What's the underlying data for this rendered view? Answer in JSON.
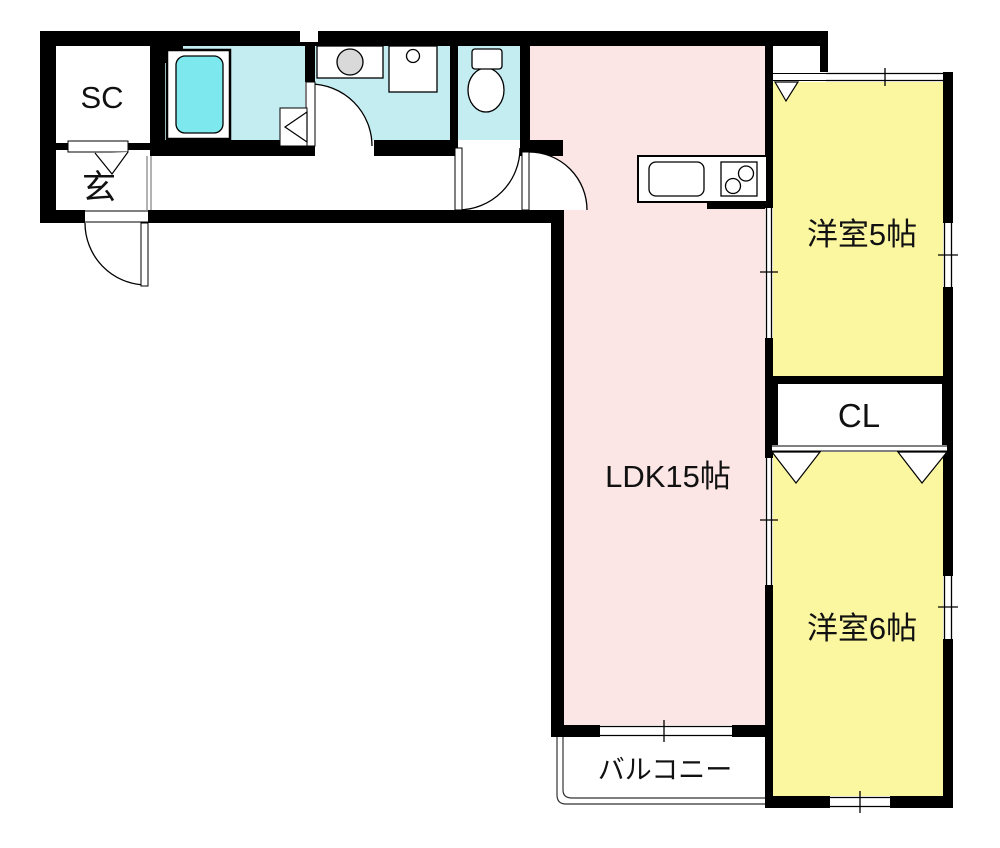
{
  "floorplan": {
    "rooms": {
      "sc": {
        "label": "SC"
      },
      "genkan": {
        "label": "玄"
      },
      "ldk": {
        "label": "LDK15帖"
      },
      "bedroom5": {
        "label": "洋室5帖"
      },
      "closet": {
        "label": "CL"
      },
      "bedroom6": {
        "label": "洋室6帖"
      },
      "balcony": {
        "label": "バルコニー"
      }
    },
    "colors": {
      "wall": "#000000",
      "ldk_fill": "#fbe5e5",
      "bedroom_fill": "#fbf7a1",
      "wet_area_fill": "#c4edf2",
      "bathtub_fill": "#7de9ee",
      "washer_fill": "#d9d9d9"
    },
    "fixtures": [
      "bathtub",
      "washing-machine",
      "washbasin",
      "toilet",
      "kitchen-sink",
      "stove-burners"
    ]
  }
}
